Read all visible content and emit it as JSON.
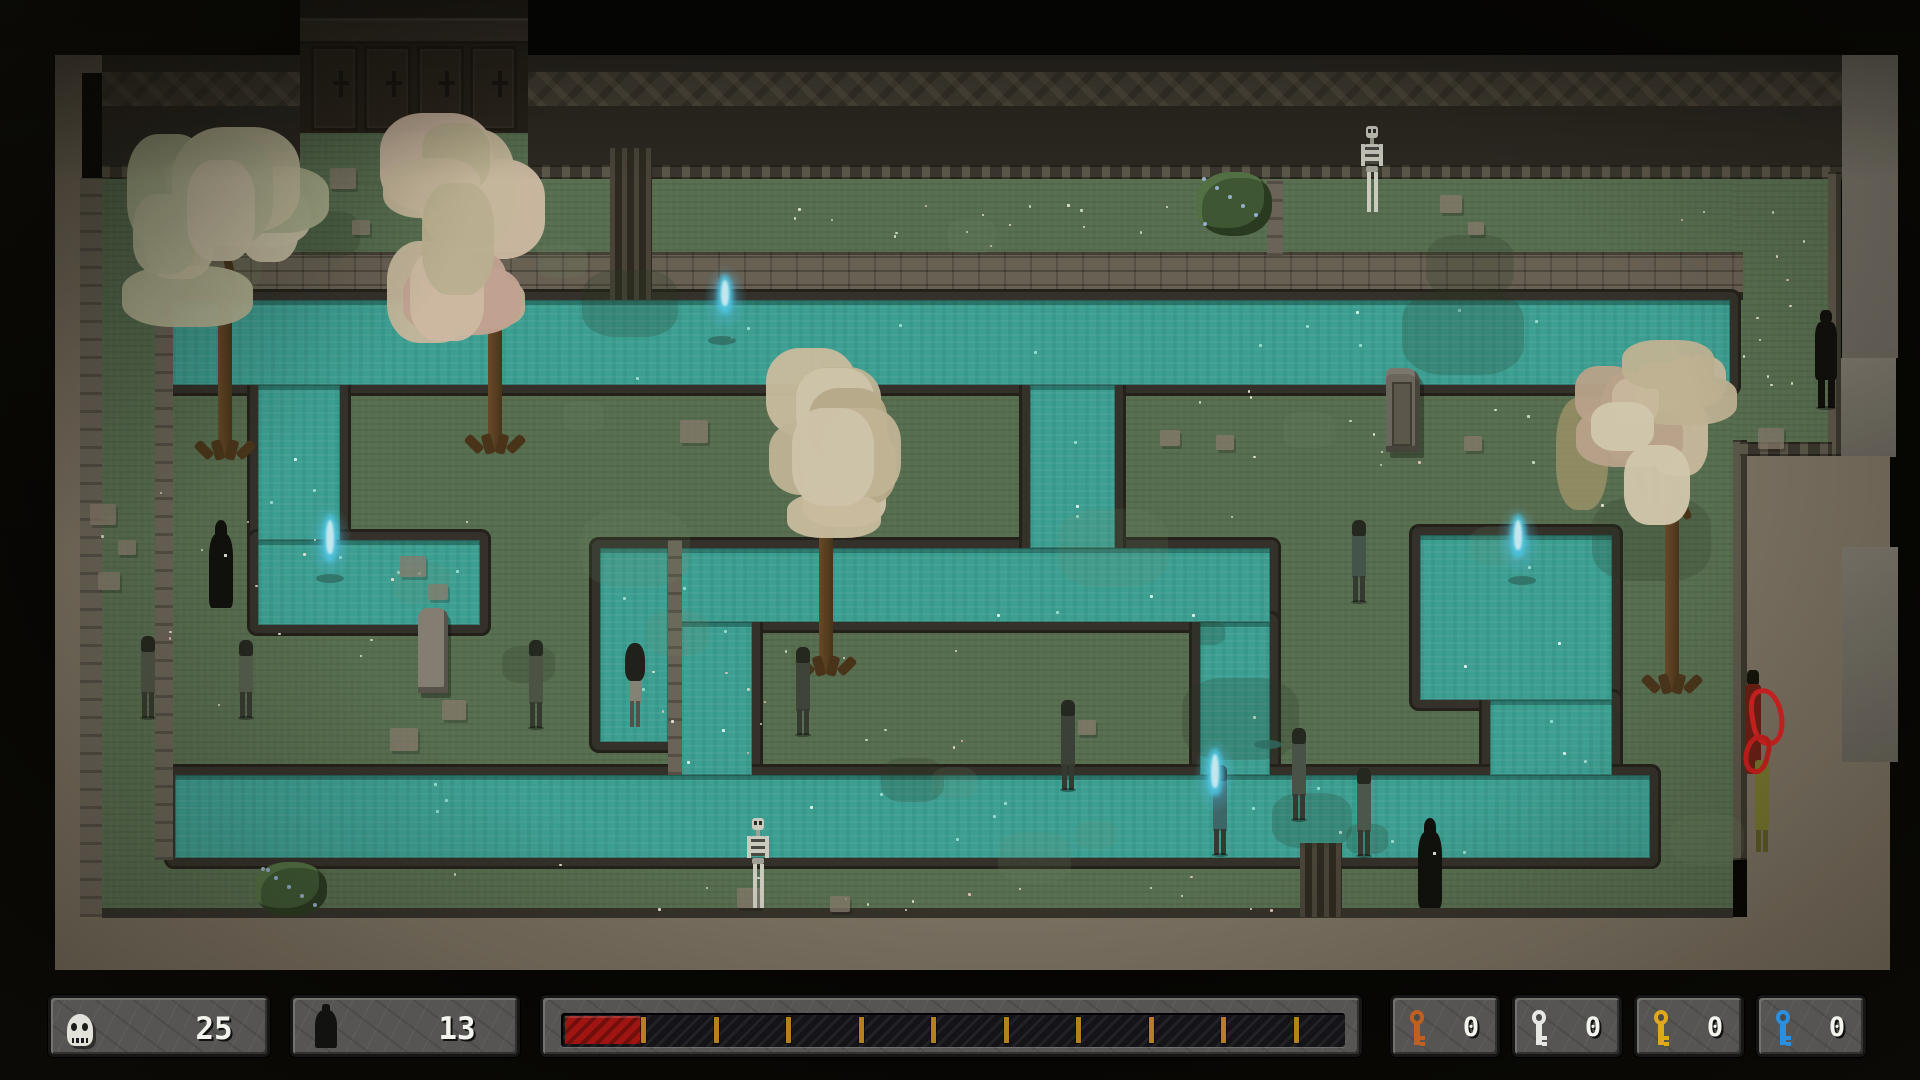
{
  "hud": {
    "skull_count": "25",
    "figure_count": "13",
    "skull_panel": {
      "x": 48,
      "y": 995,
      "w": 222,
      "h": 62
    },
    "figure_panel": {
      "x": 290,
      "y": 995,
      "w": 230,
      "h": 62
    },
    "health_panel": {
      "x": 540,
      "y": 995,
      "w": 822,
      "h": 62
    },
    "health": {
      "filled_segments": 1,
      "total_segments": 11,
      "bar": {
        "x": 558,
        "y": 1010,
        "w": 784,
        "h": 34
      },
      "red": {
        "x": 562,
        "y": 1013,
        "w": 76,
        "h": 28
      },
      "tick_start": 638,
      "tick_step": 72.5,
      "tick_count": 10
    },
    "keys": [
      {
        "name": "orange-key",
        "color": "#c06020",
        "count": "0",
        "x": 1390
      },
      {
        "name": "silver-key",
        "color": "#e6e6e2",
        "count": "0",
        "x": 1512
      },
      {
        "name": "gold-key",
        "color": "#e0a81c",
        "count": "0",
        "x": 1634
      },
      {
        "name": "blue-key",
        "color": "#2b8fdf",
        "count": "0",
        "x": 1756
      }
    ],
    "key_panel": {
      "y": 995,
      "w": 110,
      "h": 62
    }
  },
  "map": {
    "outer": [
      {
        "name": "frame-top",
        "cls": "tan",
        "x": 55,
        "y": 55,
        "w": 1835,
        "h": 18
      },
      {
        "name": "frame-left",
        "cls": "tan",
        "x": 55,
        "y": 55,
        "w": 27,
        "h": 862
      },
      {
        "name": "frame-bottom",
        "cls": "tan",
        "x": 55,
        "y": 917,
        "w": 1835,
        "h": 53
      },
      {
        "name": "left-outer-column",
        "cls": "column",
        "x": 80,
        "y": 178,
        "w": 22,
        "h": 739
      },
      {
        "name": "right-outer-grey-upper",
        "cls": "greycol",
        "x": 1842,
        "y": 55,
        "w": 56,
        "h": 303
      },
      {
        "name": "right-alcove",
        "cls": "greycol",
        "x": 1832,
        "y": 358,
        "w": 64,
        "h": 99
      },
      {
        "name": "right-corridor-tan",
        "cls": "tan",
        "x": 1747,
        "y": 456,
        "w": 143,
        "h": 514
      },
      {
        "name": "right-grey-column",
        "cls": "greycol",
        "x": 1842,
        "y": 547,
        "w": 58,
        "h": 215
      },
      {
        "name": "black-east-edge",
        "cls": "",
        "x": 1898,
        "y": 0,
        "w": 22,
        "h": 1080
      }
    ],
    "wall": {
      "x": 102,
      "y": 55,
      "w": 1740,
      "h": 125,
      "frieze_y": 72,
      "frieze_h": 34,
      "studs_y": 165,
      "studs_h": 14
    },
    "doorway": {
      "x": 300,
      "y": 0,
      "w": 228,
      "h": 133,
      "leaves": 4,
      "green_below_h": 50
    },
    "greens": [
      {
        "name": "field-main",
        "x": 102,
        "y": 179,
        "w": 1631,
        "h": 738
      },
      {
        "name": "field-east-upper",
        "x": 1733,
        "y": 179,
        "w": 95,
        "h": 277
      }
    ],
    "bank_band": {
      "x": 172,
      "y": 252,
      "w": 1571,
      "h": 48
    },
    "water": [
      {
        "name": "top-canal",
        "x": 172,
        "y": 300,
        "w": 1558,
        "h": 85
      },
      {
        "name": "left-drop",
        "x": 258,
        "y": 385,
        "w": 82,
        "h": 155
      },
      {
        "name": "left-basin",
        "x": 258,
        "y": 540,
        "w": 222,
        "h": 85
      },
      {
        "name": "mid-canal",
        "x": 600,
        "y": 548,
        "w": 670,
        "h": 74
      },
      {
        "name": "mid-drop",
        "x": 1030,
        "y": 385,
        "w": 85,
        "h": 163
      },
      {
        "name": "pocket-channel",
        "x": 600,
        "y": 548,
        "w": 68,
        "h": 194
      },
      {
        "name": "connector-channel",
        "x": 680,
        "y": 622,
        "w": 72,
        "h": 153
      },
      {
        "name": "right-mid-drop",
        "x": 1200,
        "y": 622,
        "w": 70,
        "h": 153
      },
      {
        "name": "right-basin",
        "x": 1420,
        "y": 535,
        "w": 192,
        "h": 165
      },
      {
        "name": "right-drop",
        "x": 1490,
        "y": 700,
        "w": 122,
        "h": 75
      },
      {
        "name": "bottom-canal",
        "x": 175,
        "y": 775,
        "w": 1475,
        "h": 83
      }
    ],
    "walls_extra": [
      {
        "name": "inner-strip-wall",
        "cls": "column",
        "x": 155,
        "y": 315,
        "w": 18,
        "h": 545
      },
      {
        "name": "pocket-divider-wall",
        "cls": "column",
        "x": 668,
        "y": 540,
        "w": 14,
        "h": 235
      },
      {
        "name": "ne-pocket-wall",
        "cls": "column",
        "x": 1267,
        "y": 180,
        "w": 16,
        "h": 76
      },
      {
        "name": "east-strip-lower",
        "cls": "studs",
        "x": 1733,
        "y": 440,
        "w": 14,
        "h": 420
      },
      {
        "name": "east-strip-upper",
        "cls": "studs",
        "x": 1828,
        "y": 172,
        "w": 13,
        "h": 284
      },
      {
        "name": "east-step-wall",
        "cls": "studs",
        "x": 1740,
        "y": 442,
        "w": 92,
        "h": 14
      },
      {
        "name": "south-field-line",
        "cls": "",
        "x": 102,
        "y": 908,
        "w": 1631,
        "h": 10
      },
      {
        "name": "fence-top",
        "cls": "fence",
        "x": 610,
        "y": 148,
        "w": 42,
        "h": 152
      },
      {
        "name": "fence-bottom",
        "cls": "fence",
        "x": 1300,
        "y": 843,
        "w": 42,
        "h": 74
      }
    ],
    "stones": [
      {
        "x": 330,
        "y": 168,
        "s": 26
      },
      {
        "x": 390,
        "y": 170,
        "s": 20
      },
      {
        "x": 352,
        "y": 220,
        "s": 18
      },
      {
        "x": 90,
        "y": 504,
        "s": 26
      },
      {
        "x": 118,
        "y": 540,
        "s": 18
      },
      {
        "x": 98,
        "y": 572,
        "s": 22
      },
      {
        "x": 400,
        "y": 556,
        "s": 26
      },
      {
        "x": 428,
        "y": 584,
        "s": 20
      },
      {
        "x": 442,
        "y": 700,
        "s": 24
      },
      {
        "x": 390,
        "y": 728,
        "s": 28
      },
      {
        "x": 737,
        "y": 888,
        "s": 24
      },
      {
        "x": 830,
        "y": 896,
        "s": 20
      },
      {
        "x": 680,
        "y": 420,
        "s": 28
      },
      {
        "x": 1160,
        "y": 430,
        "s": 20
      },
      {
        "x": 1216,
        "y": 435,
        "s": 18
      },
      {
        "x": 1464,
        "y": 436,
        "s": 18
      },
      {
        "x": 1440,
        "y": 195,
        "s": 22
      },
      {
        "x": 1468,
        "y": 222,
        "s": 16
      },
      {
        "x": 1758,
        "y": 428,
        "s": 26
      },
      {
        "x": 1078,
        "y": 720,
        "s": 18
      }
    ],
    "dirt_patch": {
      "x": 1556,
      "y": 398,
      "w": 52,
      "h": 112
    },
    "bushes": [
      {
        "name": "bush-top-right",
        "x": 1196,
        "y": 172,
        "w": 76,
        "h": 64,
        "dots": "#9db8d8"
      },
      {
        "name": "bush-bottom-left",
        "x": 255,
        "y": 862,
        "w": 72,
        "h": 54,
        "dots": "#9db8d8"
      }
    ],
    "tombstone": {
      "x": 418,
      "y": 608,
      "w": 30,
      "h": 85
    },
    "outhouse": {
      "x": 1386,
      "y": 368,
      "w": 34,
      "h": 84
    },
    "trees": [
      {
        "name": "blossom-tree-nw",
        "cx": 218,
        "cy": 225,
        "rx": 112,
        "ry": 120,
        "base_x": 225,
        "base_y": 458,
        "trunk_h": 160,
        "pal": [
          "#cfc9a8",
          "#c2c2a0",
          "#d6cdb2",
          "#b4ba96"
        ]
      },
      {
        "name": "blossom-tree-n",
        "cx": 463,
        "cy": 235,
        "rx": 95,
        "ry": 125,
        "base_x": 495,
        "base_y": 452,
        "trunk_h": 165,
        "pal": [
          "#d8c3ad",
          "#cfc0a4",
          "#c4b898",
          "#ccab9b"
        ]
      },
      {
        "name": "blossom-tree-center",
        "cx": 828,
        "cy": 450,
        "rx": 76,
        "ry": 105,
        "base_x": 826,
        "base_y": 674,
        "trunk_h": 170,
        "pal": [
          "#d4c6a8",
          "#cabd9e",
          "#dbcfb4",
          "#c0b392"
        ]
      },
      {
        "name": "blossom-tree-e",
        "cx": 1660,
        "cy": 435,
        "rx": 88,
        "ry": 102,
        "base_x": 1672,
        "base_y": 692,
        "trunk_h": 190,
        "pal": [
          "#d3c2a6",
          "#c9bb9c",
          "#ddd2b8",
          "#c3ab93"
        ]
      }
    ],
    "figures": [
      {
        "name": "cloaked-reaper-left",
        "type": "reaper",
        "x": 206,
        "y": 520,
        "w": 30,
        "h": 92
      },
      {
        "name": "zombie-far-left",
        "type": "zombie",
        "x": 139,
        "y": 636,
        "w": 17,
        "h": 82,
        "tint": "#4e5547"
      },
      {
        "name": "zombie-left",
        "type": "zombie",
        "x": 237,
        "y": 640,
        "w": 17,
        "h": 78,
        "tint": "#566050"
      },
      {
        "name": "zombie-mid-left",
        "type": "zombie",
        "x": 527,
        "y": 640,
        "w": 18,
        "h": 88,
        "tint": "#4e5547"
      },
      {
        "name": "ghost-girl-in-water",
        "type": "girl",
        "x": 622,
        "y": 643,
        "w": 25,
        "h": 84
      },
      {
        "name": "zombie-by-tree",
        "type": "zombie",
        "x": 793,
        "y": 647,
        "w": 19,
        "h": 88,
        "tint": "#3f453b"
      },
      {
        "name": "zombie-center",
        "type": "zombie",
        "x": 1058,
        "y": 700,
        "w": 20,
        "h": 90,
        "tint": "#3c423a"
      },
      {
        "name": "zombie-with-wisp",
        "type": "zombie",
        "x": 1210,
        "y": 765,
        "w": 20,
        "h": 90,
        "tint": "#3d6a6e"
      },
      {
        "name": "zombie-bank",
        "type": "zombie",
        "x": 1290,
        "y": 728,
        "w": 18,
        "h": 92,
        "tint": "#49544a"
      },
      {
        "name": "zombie-in-canal",
        "type": "zombie",
        "x": 1355,
        "y": 768,
        "w": 17,
        "h": 88,
        "tint": "#4e5a50"
      },
      {
        "name": "cloaked-reaper-bottom",
        "type": "reaper",
        "x": 1414,
        "y": 818,
        "w": 32,
        "h": 94
      },
      {
        "name": "zombie-islet",
        "type": "zombie",
        "x": 1350,
        "y": 520,
        "w": 17,
        "h": 82,
        "tint": "#46564e"
      },
      {
        "name": "skeleton-top",
        "type": "skeleton",
        "x": 1360,
        "y": 126,
        "w": 24,
        "h": 88
      },
      {
        "name": "skeleton-bottom",
        "type": "skeleton",
        "x": 746,
        "y": 818,
        "w": 24,
        "h": 92
      },
      {
        "name": "shadow-figure-east",
        "type": "shadow",
        "x": 1813,
        "y": 310,
        "w": 26,
        "h": 98
      },
      {
        "name": "ribbon-figure",
        "type": "ribbon",
        "x": 1742,
        "y": 670,
        "w": 42,
        "h": 185
      }
    ],
    "wisps": [
      {
        "name": "soul-wisp-top",
        "x": 725,
        "y": 278,
        "h": 40
      },
      {
        "name": "soul-wisp-left",
        "x": 330,
        "y": 518,
        "h": 48
      },
      {
        "name": "soul-wisp-right",
        "x": 1518,
        "y": 518,
        "h": 44
      },
      {
        "name": "soul-wisp-bottom",
        "x": 1215,
        "y": 752,
        "h": 48
      }
    ],
    "fish": [
      {
        "x": 722,
        "y": 340
      },
      {
        "x": 330,
        "y": 578
      },
      {
        "x": 1522,
        "y": 580
      },
      {
        "x": 1268,
        "y": 744
      }
    ]
  }
}
